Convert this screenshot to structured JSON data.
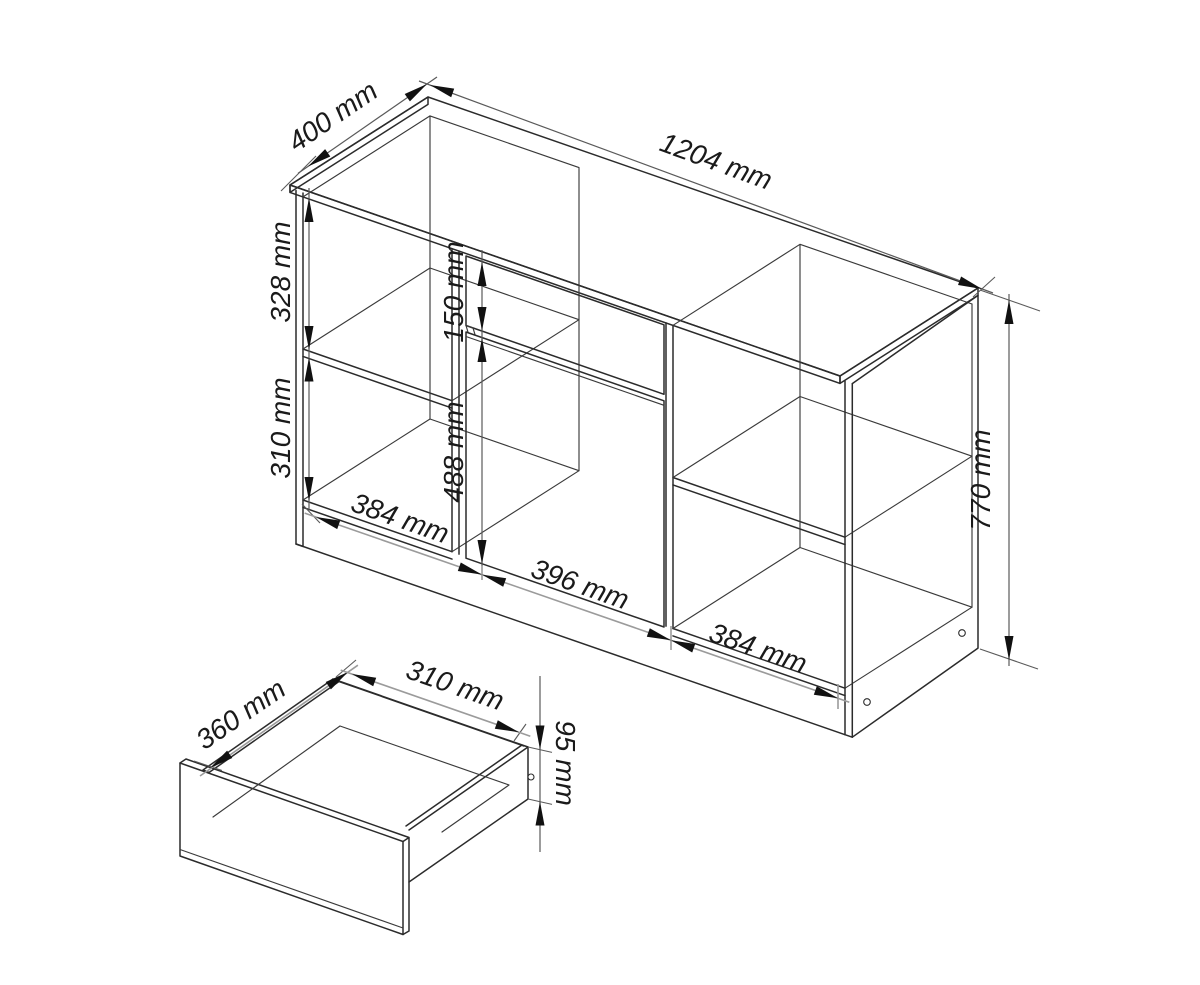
{
  "diagram": {
    "unit": "mm",
    "cabinet": {
      "depth": "400 mm",
      "width": "1204 mm",
      "height": "770 mm",
      "left_upper_compartment_height": "328 mm",
      "left_lower_compartment_height": "310 mm",
      "drawer_front_height": "150 mm",
      "door_height": "488 mm",
      "left_compartment_width": "384 mm",
      "middle_section_width": "396 mm",
      "right_compartment_width": "384 mm"
    },
    "drawer": {
      "depth": "360 mm",
      "width": "310 mm",
      "side_height": "95 mm"
    }
  }
}
